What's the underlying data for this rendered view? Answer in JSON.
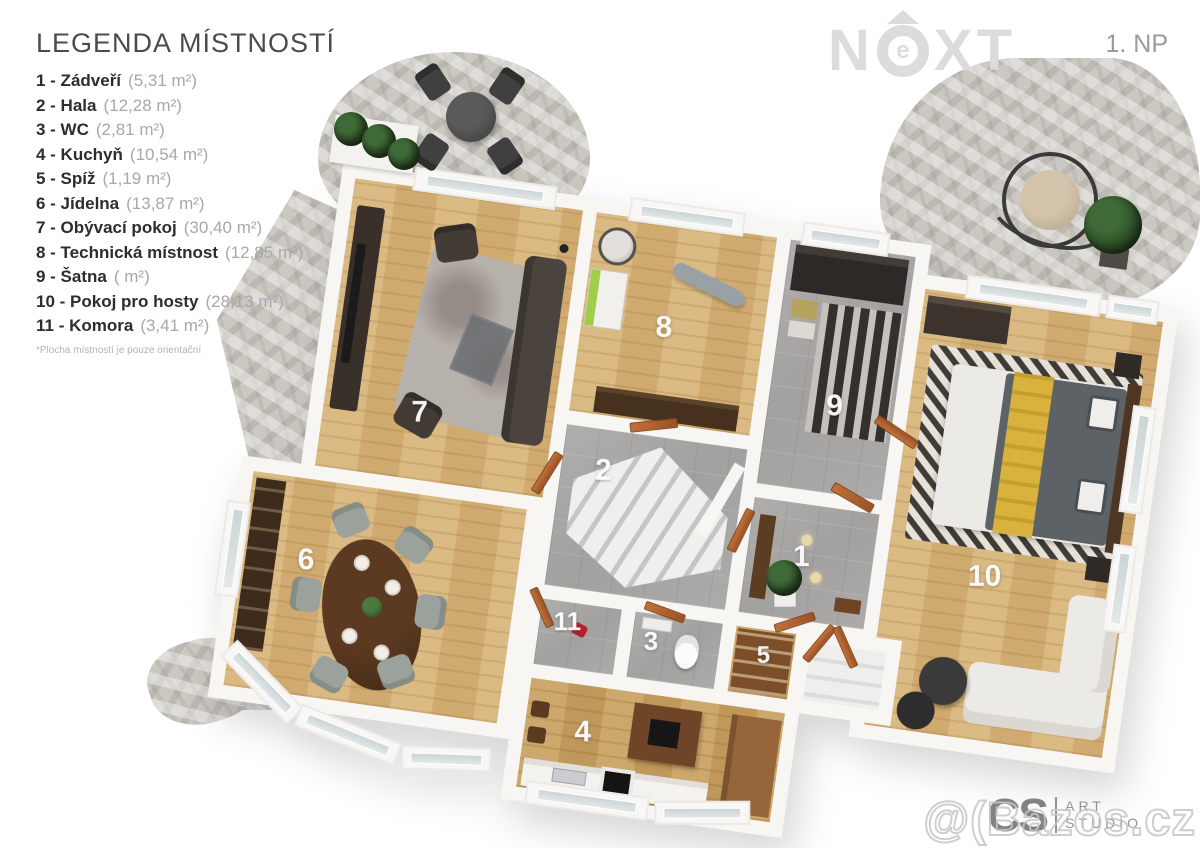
{
  "header": {
    "floor_label": "1. NP",
    "logo": {
      "full": "NEXT",
      "n": "N",
      "e": "e",
      "x": "X",
      "t": "T"
    }
  },
  "legend": {
    "title": "LEGENDA MÍSTNOSTÍ",
    "items": [
      {
        "label": "1 - Zádveří",
        "area": "(5,31 m²)"
      },
      {
        "label": "2 - Hala",
        "area": "(12,28 m²)"
      },
      {
        "label": "3 - WC",
        "area": "(2,81 m²)"
      },
      {
        "label": "4 - Kuchyň",
        "area": "(10,54 m²)"
      },
      {
        "label": "5 - Spíž",
        "area": "(1,19 m²)"
      },
      {
        "label": "6 - Jídelna",
        "area": "(13,87 m²)"
      },
      {
        "label": "7 - Obývací pokoj",
        "area": "(30,40 m²)"
      },
      {
        "label": "8 - Technická místnost",
        "area": "(12,85 m²)"
      },
      {
        "label": "9 - Šatna",
        "area": "( m²)"
      },
      {
        "label": "10 - Pokoj pro hosty",
        "area": "(28,13 m²)"
      },
      {
        "label": "11 - Komora",
        "area": "(3,41 m²)"
      }
    ],
    "footnote": "*Plocha místností je pouze orientační"
  },
  "plan": {
    "labels": [
      "1",
      "2",
      "3",
      "4",
      "5",
      "6",
      "7",
      "8",
      "9",
      "10",
      "11"
    ],
    "room_names": [
      "Zádveří",
      "Hala",
      "WC",
      "Kuchyň",
      "Spíž",
      "Jídelna",
      "Obývací pokoj",
      "Technická místnost",
      "Šatna",
      "Pokoj pro hosty",
      "Komora"
    ]
  },
  "watermark": {
    "text": "@(Bazos.cz"
  },
  "studio": {
    "monogram": "CS",
    "line1": "ART",
    "line2": "STUDIO"
  },
  "colors": {
    "wood_floor": "#d7b377",
    "kitchen_wood": "#c9a162",
    "gray_tile": "#a7a5a3",
    "stone_terrace": "#cbc8c2",
    "wall_white": "#f7f6f3",
    "door_wood": "#b4622d",
    "appliance_green": "#9fcf4a",
    "throw_yellow": "#d9b23e",
    "logo_gray": "#dcdcdc"
  }
}
